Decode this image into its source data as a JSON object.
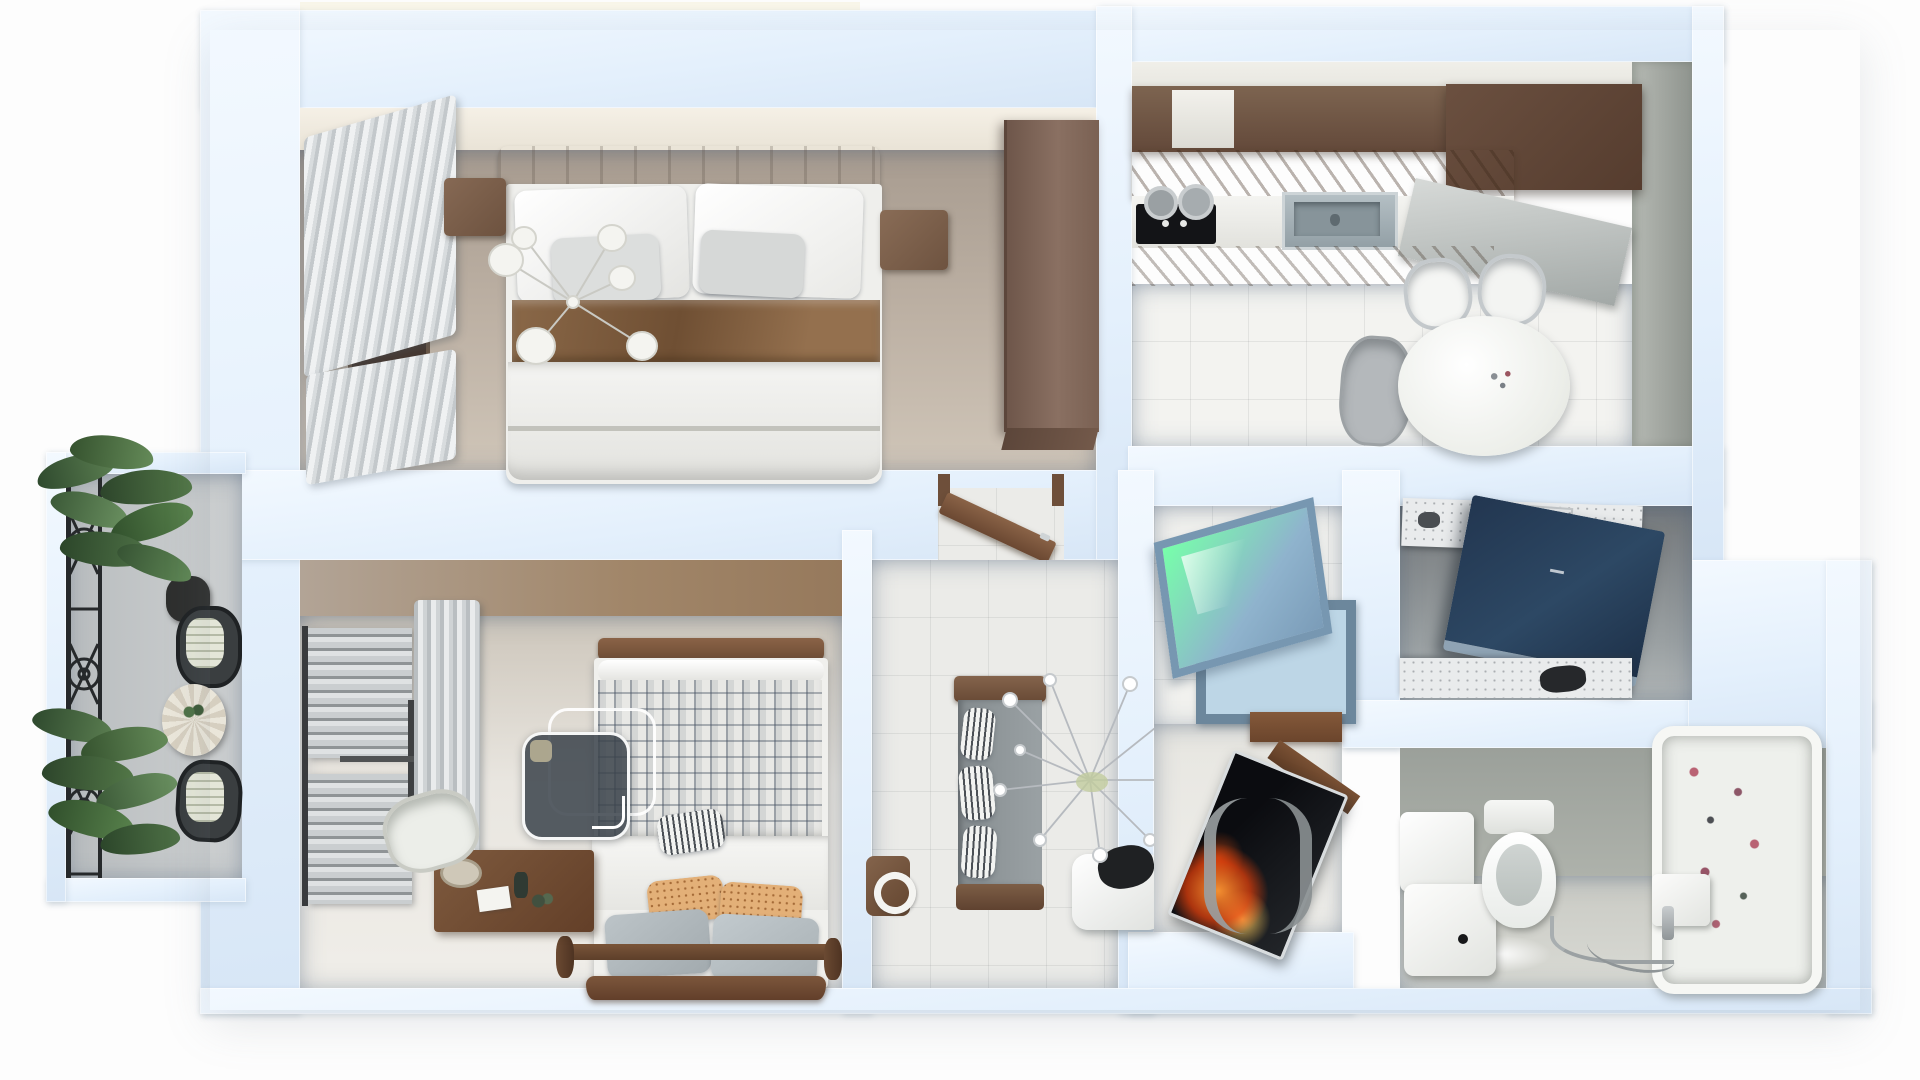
{
  "scene": {
    "kind": "top-down 3d apartment floor plan render",
    "background": "#ffffff",
    "has_text": false
  },
  "palette": {
    "wall": "#e4f0fc",
    "wall_highlight": "#f3f9ff",
    "bedroom1_floor_dark": "#a89c90",
    "bedroom1_floor_light": "#cfc5b8",
    "bedroom1_wallface": "#f2ede2",
    "bedroom2_floor": "#e9e6e0",
    "bedroom2_wallface": "#ab9c8c",
    "kitchen_tile": "#f3f3f0",
    "kitchen_wallface_gray": "#a7aca6",
    "hall_tile": "#ebebe8",
    "roomA_tile": "#f1f1ee",
    "roomB_shadow": "#7c8184",
    "bath_concrete": "#a3a8a1",
    "bath_floor": "#d6d7d1",
    "balcony_floor": "#c6c9ca",
    "wood_dark": "#5f4636",
    "wood_mid": "#7b5f49",
    "wood_light": "#9a7a5c",
    "curtain_gray": "#d4d8da",
    "bedding_white": "#f3f3f1",
    "bed_runner_brown": "#8a6848",
    "cooktop_black": "#131417",
    "sink_steel": "#9aa7ad",
    "window_blue_glass": "#a4c4dc",
    "window_blue_frame": "#6f8ba2",
    "navy_panel": "#273c52",
    "tv_flame_orange": "#ff7a1e",
    "tub_white": "#eef0ec",
    "tub_flower_red": "#b04a5e",
    "plant_green": "#4e7146",
    "iron_black": "#26292b",
    "watermark_fill": "rgba(58,66,74,0.85)",
    "watermark_border": "#ffffff"
  },
  "rooms": [
    {
      "name": "master bedroom",
      "position": "top-left"
    },
    {
      "name": "kitchen dining",
      "position": "top-right"
    },
    {
      "name": "balcony",
      "position": "left"
    },
    {
      "name": "second bedroom",
      "position": "bottom-left"
    },
    {
      "name": "hallway",
      "position": "center"
    },
    {
      "name": "utility room",
      "position": "center-right"
    },
    {
      "name": "laundry room",
      "position": "right"
    },
    {
      "name": "bathroom",
      "position": "bottom-right"
    }
  ],
  "furniture": {
    "master_bedroom": [
      "gray curtains",
      "window",
      "double bed",
      "white pillows",
      "brown bed runner",
      "nightstand left",
      "nightstand right",
      "ceiling chandelier",
      "wardrobe",
      "open door leaf"
    ],
    "kitchen": [
      "upper cabinets",
      "carved cabinet band",
      "black cooktop",
      "steel sink",
      "gray counter slab",
      "round dining table",
      "white chair",
      "white chair",
      "gray chair"
    ],
    "balcony": [
      "wrought iron railing",
      "potted plants",
      "bistro chair",
      "bistro chair",
      "striped round table"
    ],
    "second_bedroom": [
      "towel radiator",
      "gray curtain",
      "plaid bed",
      "striped pillow",
      "patterned pillows",
      "gray pillows",
      "bed posts",
      "foot bench",
      "desk",
      "desk chair",
      "side stool"
    ],
    "hallway": [
      "open door leaf",
      "bench sofa",
      "striped cushions",
      "white ottoman",
      "crystal branch decor"
    ],
    "utility_room": [
      "blue awning window",
      "window frame",
      "wood shelf",
      "tv screen with flames",
      "curved side table"
    ],
    "laundry_room": [
      "shelf with patterned boxes",
      "navy tilted panel",
      "lower shelf items"
    ],
    "bathroom": [
      "cistern",
      "laundry cube",
      "toilet",
      "floral bathtub",
      "faucet hose",
      "wall box",
      "floor glow"
    ]
  },
  "watermark": {
    "shape": "two overlapping rounded squares",
    "front_fill": "rgba(58,66,74,0.85)",
    "outline": "#ffffff",
    "offset": "back square shifted up-right"
  }
}
